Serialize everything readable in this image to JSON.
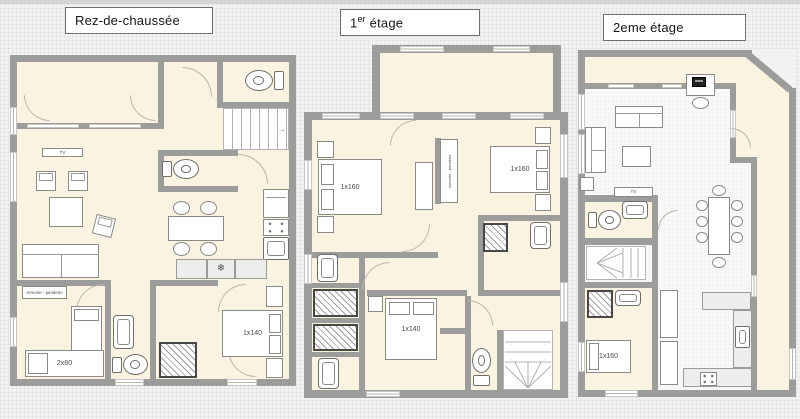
{
  "colors": {
    "bg": "#f2f2f0",
    "wall": "#9c9c9b",
    "room": "#faf3e1",
    "counter": "#ededeb"
  },
  "titles": {
    "floor0": "Rez-de-chaussée",
    "floor1_num": "1",
    "floor1_sup": "er",
    "floor1_rest": " étage",
    "floor2": "2eme étage"
  },
  "labels": {
    "tv_ground": "TV",
    "tv_floor2": "TV",
    "armoire_ground": "Armoire - penderie",
    "armoire_floor1": "Armoire - penderie",
    "bed_ground_single": "2x80",
    "bed_ground_double": "1x140",
    "bed_floor1_left": "1x160",
    "bed_floor1_right": "1x160",
    "bed_floor1_bottom": "1x140",
    "bed_floor2": "1x160"
  },
  "icons": {
    "freezer_snowflake": "❄",
    "stairs_arrow": "→"
  }
}
